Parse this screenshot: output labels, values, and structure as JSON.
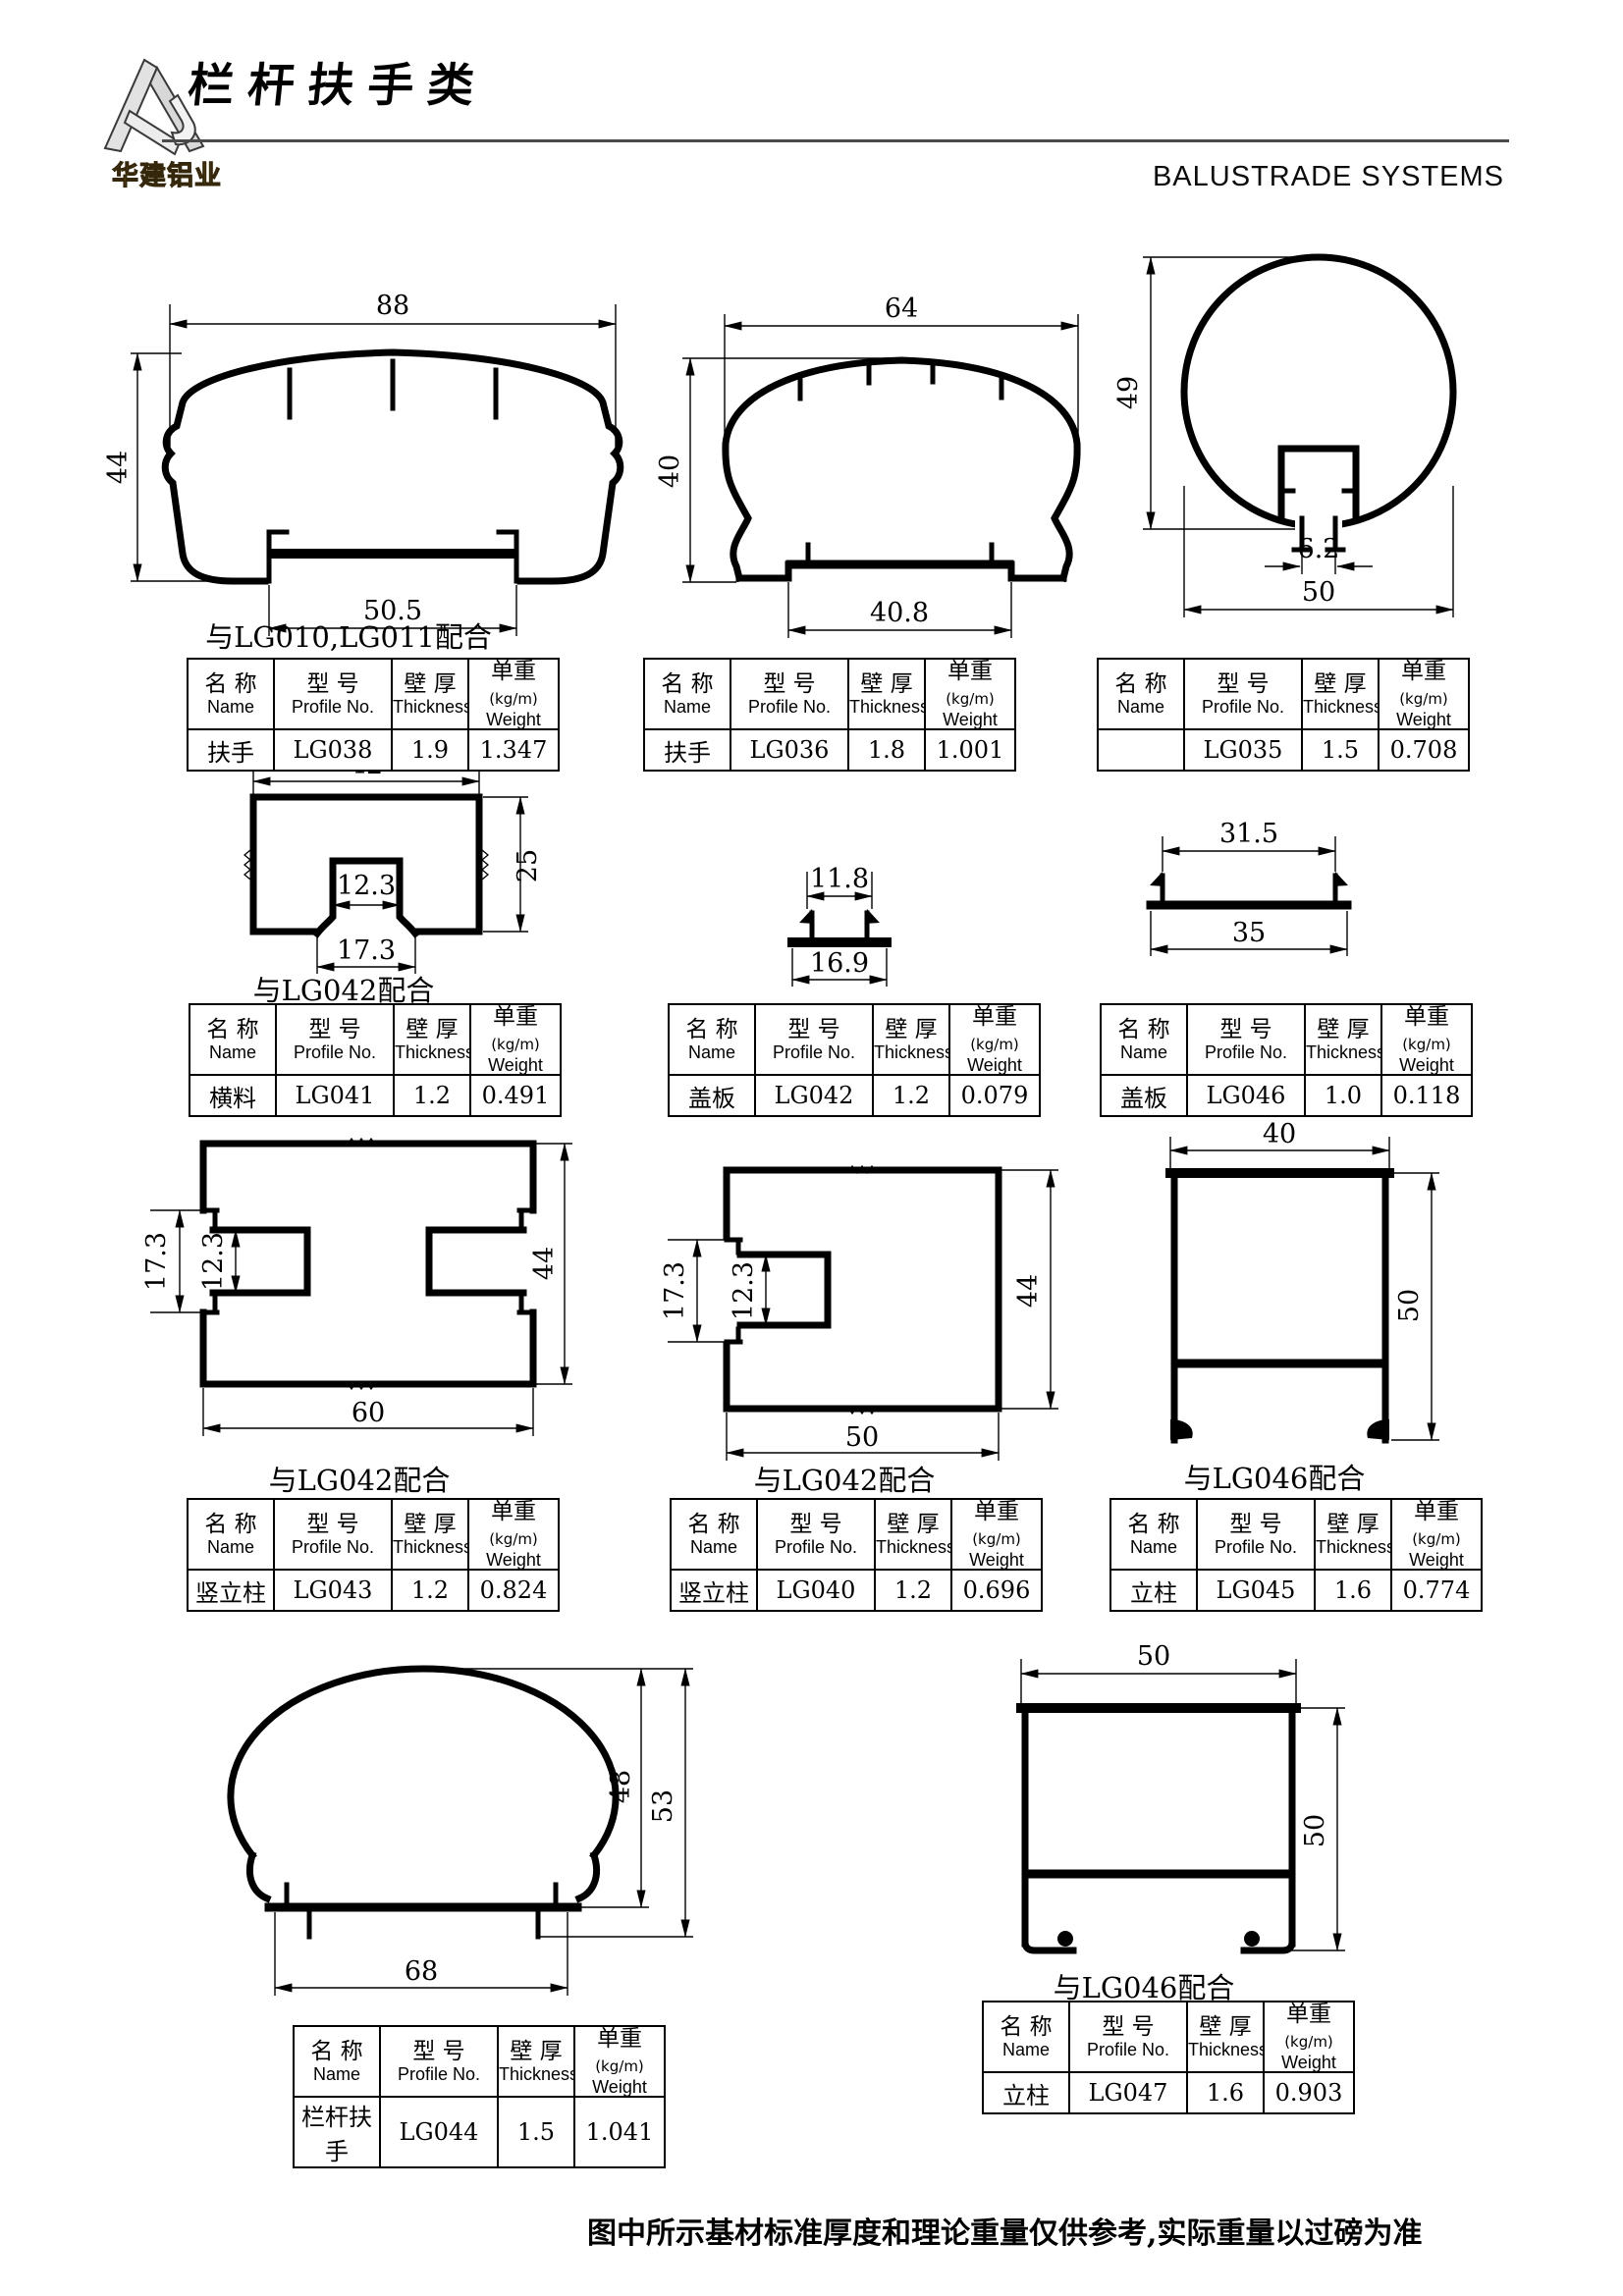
{
  "header": {
    "logo_text": "华建铝业",
    "title": "栏杆扶手类",
    "subtitle": "BALUSTRADE SYSTEMS"
  },
  "table_headers": {
    "name_cn": "名 称",
    "name_en": "Name",
    "profile_cn": "型 号",
    "profile_en": "Profile No.",
    "thickness_cn": "壁 厚",
    "thickness_en": "Thickness",
    "weight_cn": "单重",
    "weight_unit": "(kg/m)",
    "weight_en": "Weight"
  },
  "profiles": [
    {
      "id": "LG038",
      "name": "扶手",
      "profile_no": "LG038",
      "thickness": "1.9",
      "weight": "1.347",
      "caption": "与LG010,LG011配合",
      "dims": {
        "width": "88",
        "height": "44",
        "bottom": "50.5"
      }
    },
    {
      "id": "LG036",
      "name": "扶手",
      "profile_no": "LG036",
      "thickness": "1.8",
      "weight": "1.001",
      "caption": "",
      "dims": {
        "width": "64",
        "height": "40",
        "bottom": "40.8"
      }
    },
    {
      "id": "LG035",
      "name": "",
      "profile_no": "LG035",
      "thickness": "1.5",
      "weight": "0.708",
      "caption": "",
      "dims": {
        "height": "49",
        "slot": "6.2",
        "width": "50"
      }
    },
    {
      "id": "LG041",
      "name": "横料",
      "profile_no": "LG041",
      "thickness": "1.2",
      "weight": "0.491",
      "caption": "与LG042配合",
      "dims": {
        "width": "42",
        "height": "25",
        "inner": "12.3",
        "outer": "17.3"
      }
    },
    {
      "id": "LG042",
      "name": "盖板",
      "profile_no": "LG042",
      "thickness": "1.2",
      "weight": "0.079",
      "caption": "",
      "dims": {
        "top": "11.8",
        "bottom": "16.9"
      }
    },
    {
      "id": "LG046",
      "name": "盖板",
      "profile_no": "LG046",
      "thickness": "1.0",
      "weight": "0.118",
      "caption": "",
      "dims": {
        "top": "31.5",
        "bottom": "35"
      }
    },
    {
      "id": "LG043",
      "name": "竖立柱",
      "profile_no": "LG043",
      "thickness": "1.2",
      "weight": "0.824",
      "caption": "与LG042配合",
      "dims": {
        "outer": "17.3",
        "inner": "12.3",
        "height": "44",
        "width": "60"
      }
    },
    {
      "id": "LG040",
      "name": "竖立柱",
      "profile_no": "LG040",
      "thickness": "1.2",
      "weight": "0.696",
      "caption": "与LG042配合",
      "dims": {
        "outer": "17.3",
        "inner": "12.3",
        "height": "44",
        "width": "50"
      }
    },
    {
      "id": "LG045",
      "name": "立柱",
      "profile_no": "LG045",
      "thickness": "1.6",
      "weight": "0.774",
      "caption": "与LG046配合",
      "dims": {
        "width": "40",
        "height": "50"
      }
    },
    {
      "id": "LG044",
      "name": "栏杆扶手",
      "profile_no": "LG044",
      "thickness": "1.5",
      "weight": "1.041",
      "caption": "",
      "dims": {
        "height_inner": "48",
        "height": "53",
        "width": "68"
      }
    },
    {
      "id": "LG047",
      "name": "立柱",
      "profile_no": "LG047",
      "thickness": "1.6",
      "weight": "0.903",
      "caption": "与LG046配合",
      "dims": {
        "width": "50",
        "height": "50"
      }
    }
  ],
  "footer": {
    "note": "图中所示基材标准厚度和理论重量仅供参考,实际重量以过磅为准"
  }
}
